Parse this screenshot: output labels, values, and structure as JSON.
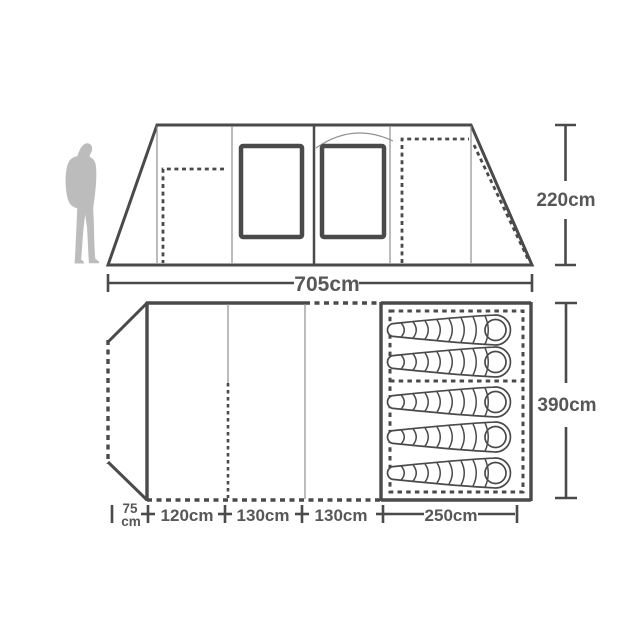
{
  "diagram": {
    "type": "product-dimension-diagram",
    "subject": "family tent side elevation and floor plan",
    "colors": {
      "line": "#4a4a4a",
      "thin_line": "#909090",
      "text": "#575757",
      "silhouette": "#bcbcbc",
      "background": "#ffffff"
    },
    "side_view": {
      "width_label": "705cm",
      "height_label": "220cm",
      "windows": 2,
      "dashed_doors": 2
    },
    "floor_plan": {
      "depth_label": "390cm",
      "segments": [
        {
          "value": "75",
          "unit": "cm"
        },
        {
          "label": "120cm"
        },
        {
          "label": "130cm"
        },
        {
          "label": "130cm"
        },
        {
          "label": "250cm"
        }
      ],
      "sleeping_bags": {
        "total": 5,
        "head_x": 497,
        "rows_y": [
          330,
          362,
          402,
          437,
          473
        ],
        "compartments": [
          {
            "bags": 2
          },
          {
            "bags": 3
          }
        ]
      }
    },
    "scale_figure": "hiker-silhouette"
  }
}
